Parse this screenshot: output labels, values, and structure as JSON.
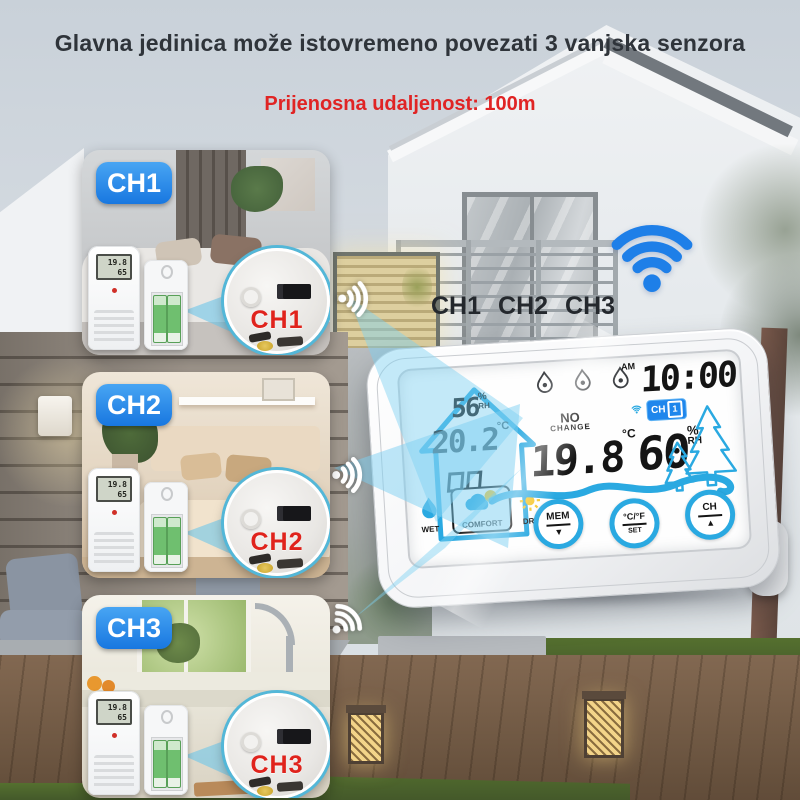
{
  "title": "Glavna jedinica može istovremeno povezati 3 vanjska senzora",
  "subtitle": "Prijenosna udaljenost: 100m",
  "channels": [
    "CH1",
    "CH2",
    "CH3"
  ],
  "panels": [
    {
      "badge": "CH1",
      "zoom_label": "CH1"
    },
    {
      "badge": "CH2",
      "zoom_label": "CH2"
    },
    {
      "badge": "CH3",
      "zoom_label": "CH3"
    }
  ],
  "sensor_lcd": {
    "top": "19.8",
    "bottom": "65"
  },
  "station": {
    "indoor": {
      "humidity": "56",
      "humidity_unit": "%",
      "humidity_sub": "RH",
      "temp": "20.2",
      "temp_unit": "°C"
    },
    "status": {
      "line1": "NO",
      "line2": "CHANGE"
    },
    "clock": {
      "meridiem": "AM",
      "time": "10:00"
    },
    "outdoor": {
      "temp": "19.8",
      "temp_unit": "°C",
      "humidity": "60",
      "humidity_unit": "%",
      "humidity_sub": "RH",
      "channel": "CH",
      "channel_num": "1"
    },
    "comfort": {
      "wet": "WET",
      "comfort": "COMFORT",
      "dry": "DRY"
    },
    "buttons": [
      {
        "top": "MEM",
        "bottom": "▼"
      },
      {
        "top": "°C/°F",
        "bottom": "SET"
      },
      {
        "top": "CH",
        "bottom": "▲"
      }
    ]
  },
  "colors": {
    "badge_blue": "#1f86ec",
    "display_blue": "#2aa9e1",
    "wifi_blue": "#1e7fe8",
    "alert_red": "#e0231c",
    "sun_yellow": "#f6c21b"
  }
}
